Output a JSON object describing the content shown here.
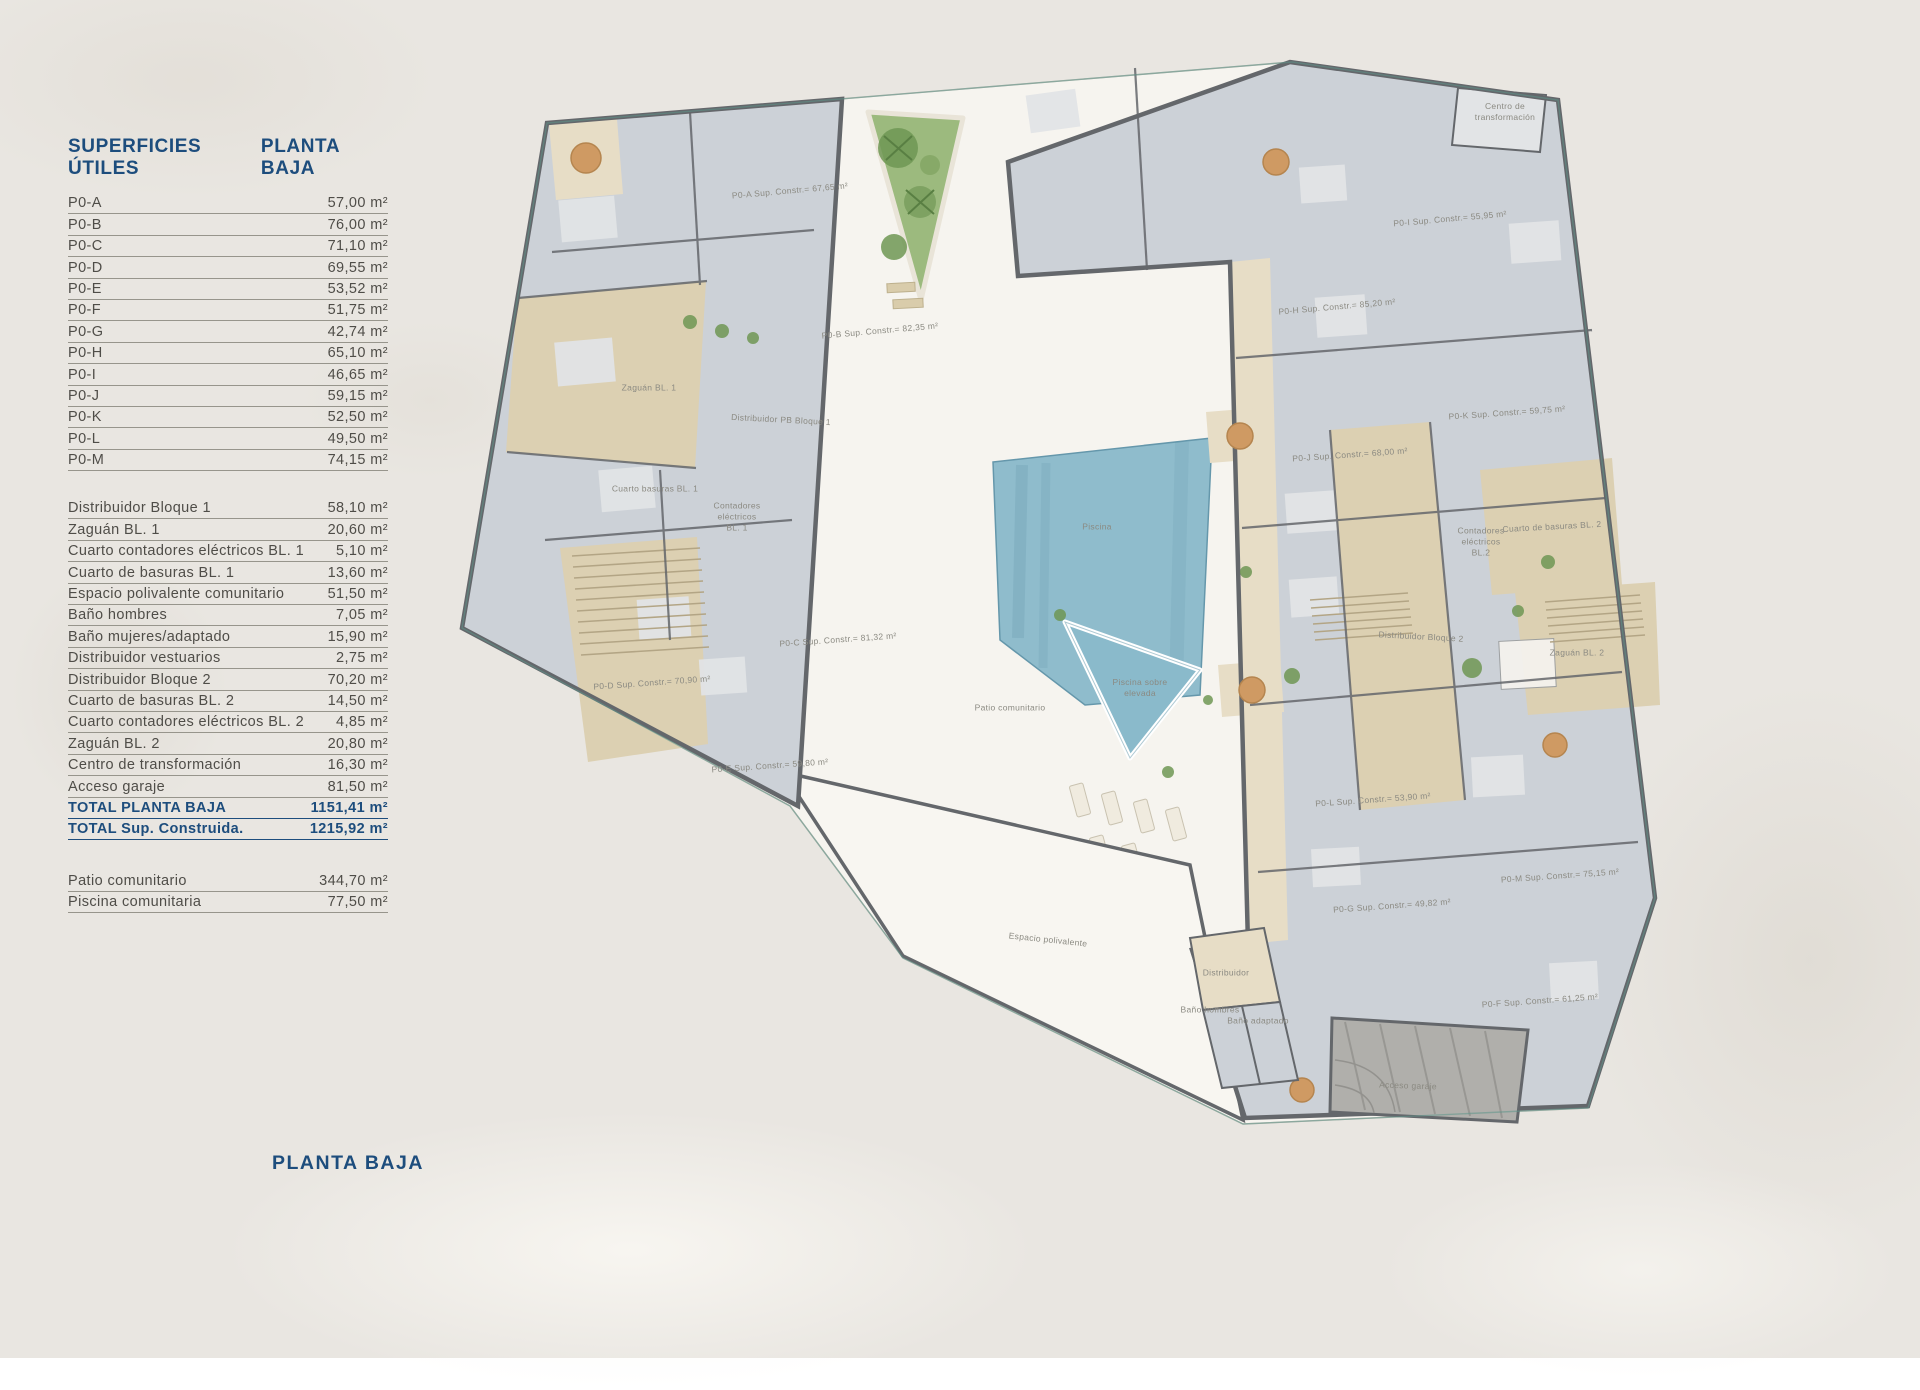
{
  "page": {
    "bottom_title": "PLANTA BAJA"
  },
  "colors": {
    "paper": "#e9e6e1",
    "site": "#f6f4ef",
    "navy": "#1d4d7d",
    "ink": "#4f4d48",
    "line": "#97958c",
    "label": "#8b8a82",
    "floor": "#ccd1d7",
    "floorLight": "#e2e4e6",
    "wall": "#64676b",
    "communal": "#dcd0b2",
    "communal2": "#e7ddc6",
    "pool": "#8abacb",
    "poolDark": "#5e93a8",
    "green": "#9cba7e",
    "greenDark": "#6f9754",
    "wood": "#cf9a63",
    "garage": "#b0afab",
    "teal": "#5f958b"
  },
  "legend": {
    "title": "SUPERFICIES ÚTILES",
    "subtitle": "PLANTA BAJA",
    "units": [
      {
        "label": "P0-A",
        "value": "57,00 m²"
      },
      {
        "label": "P0-B",
        "value": "76,00 m²"
      },
      {
        "label": "P0-C",
        "value": "71,10 m²"
      },
      {
        "label": "P0-D",
        "value": "69,55 m²"
      },
      {
        "label": "P0-E",
        "value": "53,52 m²"
      },
      {
        "label": "P0-F",
        "value": "51,75 m²"
      },
      {
        "label": "P0-G",
        "value": "42,74 m²"
      },
      {
        "label": "P0-H",
        "value": "65,10 m²"
      },
      {
        "label": "P0-I",
        "value": "46,65 m²"
      },
      {
        "label": "P0-J",
        "value": "59,15 m²"
      },
      {
        "label": "P0-K",
        "value": "52,50 m²"
      },
      {
        "label": "P0-L",
        "value": "49,50 m²"
      },
      {
        "label": "P0-M",
        "value": "74,15 m²"
      }
    ],
    "common": [
      {
        "label": "Distribuidor Bloque 1",
        "value": "58,10 m²"
      },
      {
        "label": "Zaguán BL. 1",
        "value": "20,60 m²"
      },
      {
        "label": "Cuarto contadores eléctricos BL. 1",
        "value": "5,10 m²"
      },
      {
        "label": "Cuarto de basuras BL. 1",
        "value": "13,60 m²"
      },
      {
        "label": "Espacio polivalente comunitario",
        "value": "51,50 m²"
      },
      {
        "label": "Baño hombres",
        "value": "7,05 m²"
      },
      {
        "label": "Baño mujeres/adaptado",
        "value": "15,90 m²"
      },
      {
        "label": "Distribuidor vestuarios",
        "value": "2,75 m²"
      },
      {
        "label": "Distribuidor Bloque 2",
        "value": "70,20 m²"
      },
      {
        "label": "Cuarto de basuras BL. 2",
        "value": "14,50 m²"
      },
      {
        "label": "Cuarto contadores eléctricos BL. 2",
        "value": "4,85 m²"
      },
      {
        "label": "Zaguán BL. 2",
        "value": "20,80 m²"
      },
      {
        "label": "Centro de transformación",
        "value": "16,30 m²"
      },
      {
        "label": "Acceso garaje",
        "value": "81,50 m²"
      }
    ],
    "totals": [
      {
        "label": "TOTAL PLANTA BAJA",
        "value": "1151,41 m²"
      },
      {
        "label": "TOTAL Sup. Construida.",
        "value": "1215,92 m²"
      }
    ],
    "outdoor": [
      {
        "label": "Patio comunitario",
        "value": "344,70 m²"
      },
      {
        "label": "Piscina comunitaria",
        "value": "77,50 m²"
      }
    ]
  },
  "plan": {
    "labels": [
      {
        "text": "P0-A Sup. Constr.= 67,65 m²",
        "x": 790,
        "y": 191,
        "r": -5
      },
      {
        "text": "P0-B Sup. Constr.= 82,35 m²",
        "x": 880,
        "y": 331,
        "r": -5
      },
      {
        "text": "Zaguán BL. 1",
        "x": 649,
        "y": 388,
        "r": 0
      },
      {
        "text": "Distribuidor PB Bloque 1",
        "x": 781,
        "y": 420,
        "r": 3
      },
      {
        "text": "Cuarto basuras BL. 1",
        "x": 655,
        "y": 489,
        "r": 0
      },
      {
        "text": "Contadores\neléctricos\nBL. 1",
        "x": 737,
        "y": 517,
        "r": 0
      },
      {
        "text": "P0-C Sup. Constr.= 81,32 m²",
        "x": 838,
        "y": 640,
        "r": -4
      },
      {
        "text": "P0-D Sup. Constr.= 70,90 m²",
        "x": 652,
        "y": 683,
        "r": -4
      },
      {
        "text": "P0-E Sup. Constr.= 59,80 m²",
        "x": 770,
        "y": 766,
        "r": -4
      },
      {
        "text": "Piscina",
        "x": 1097,
        "y": 527,
        "r": 0
      },
      {
        "text": "Piscina sobre\nelevada",
        "x": 1140,
        "y": 688,
        "r": 0
      },
      {
        "text": "Patio comunitario",
        "x": 1010,
        "y": 708,
        "r": 0
      },
      {
        "text": "Espacio polivalente",
        "x": 1048,
        "y": 940,
        "r": 6
      },
      {
        "text": "Distribuidor",
        "x": 1226,
        "y": 973,
        "r": 0
      },
      {
        "text": "Baño hombres",
        "x": 1210,
        "y": 1010,
        "r": 0
      },
      {
        "text": "Baño adaptado",
        "x": 1258,
        "y": 1021,
        "r": 0
      },
      {
        "text": "Acceso garaje",
        "x": 1408,
        "y": 1086,
        "r": 2
      },
      {
        "text": "Centro de\ntransformación",
        "x": 1505,
        "y": 112,
        "r": 0
      },
      {
        "text": "P0-I Sup. Constr.= 55,95 m²",
        "x": 1450,
        "y": 219,
        "r": -5
      },
      {
        "text": "P0-H Sup. Constr.= 85,20 m²",
        "x": 1337,
        "y": 307,
        "r": -5
      },
      {
        "text": "P0-K Sup. Constr.= 59,75 m²",
        "x": 1507,
        "y": 413,
        "r": -4
      },
      {
        "text": "P0-J Sup. Constr.= 68,00 m²",
        "x": 1350,
        "y": 455,
        "r": -4
      },
      {
        "text": "Cuarto de basuras BL. 2",
        "x": 1552,
        "y": 527,
        "r": -3
      },
      {
        "text": "Contadores\neléctricos\nBL.2",
        "x": 1481,
        "y": 542,
        "r": 0
      },
      {
        "text": "Distribuidor Bloque 2",
        "x": 1421,
        "y": 637,
        "r": 3
      },
      {
        "text": "Zaguán BL. 2",
        "x": 1577,
        "y": 653,
        "r": 0
      },
      {
        "text": "P0-L Sup. Constr.= 53,90 m²",
        "x": 1373,
        "y": 800,
        "r": -4
      },
      {
        "text": "P0-M Sup. Constr.= 75,15 m²",
        "x": 1560,
        "y": 876,
        "r": -4
      },
      {
        "text": "P0-G Sup. Constr.= 49,82 m²",
        "x": 1392,
        "y": 906,
        "r": -4
      },
      {
        "text": "P0-F Sup. Constr.= 61,25 m²",
        "x": 1540,
        "y": 1001,
        "r": -4
      }
    ]
  }
}
